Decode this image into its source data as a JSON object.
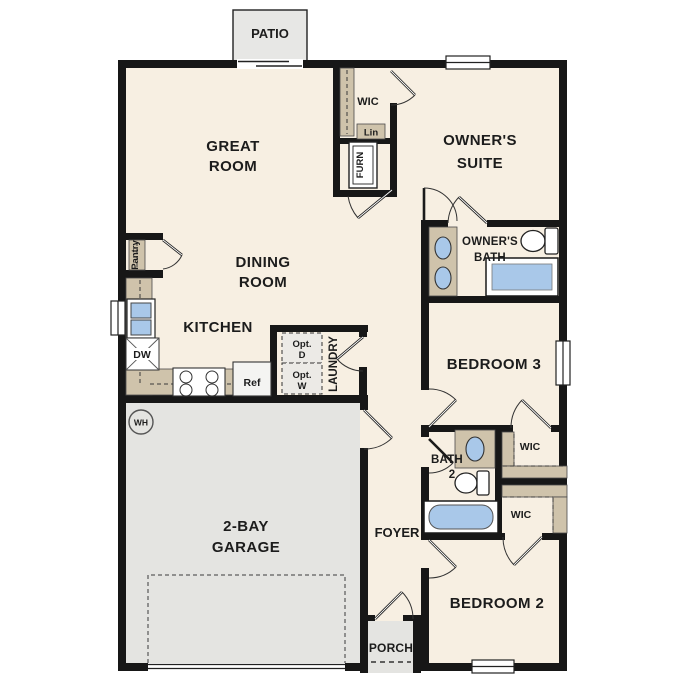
{
  "labels": {
    "patio": "PATIO",
    "great_room": [
      "GREAT",
      "ROOM"
    ],
    "wic_owner": "WIC",
    "lin": "Lin",
    "furn": "FURN",
    "owners_suite": [
      "OWNER'S",
      "SUITE"
    ],
    "owners_bath": [
      "OWNER'S",
      "BATH"
    ],
    "pantry": "Pantry",
    "dining_room": [
      "DINING",
      "ROOM"
    ],
    "kitchen": "KITCHEN",
    "dishwasher": "DW",
    "refrigerator": "Ref",
    "opt_dryer": [
      "Opt.",
      "D"
    ],
    "opt_washer": [
      "Opt.",
      "W"
    ],
    "laundry": "LAUNDRY",
    "bedroom_3": "BEDROOM 3",
    "water_heater": "WH",
    "garage": [
      "2-BAY",
      "GARAGE"
    ],
    "foyer": "FOYER",
    "bath_2": [
      "BATH",
      "2"
    ],
    "wic_bedroom_3": "WIC",
    "wic_bedroom_2": "WIC",
    "bedroom_2": "BEDROOM 2",
    "porch": "PORCH"
  },
  "colors": {
    "wall": "#171717",
    "floor": "#f7efe2",
    "garage_floor": "#e4e4e1",
    "casework_tan": "#cfc3ab",
    "fixture_blue": "#a9c8e9",
    "text": "#1c1c1c",
    "background": "#ffffff"
  }
}
